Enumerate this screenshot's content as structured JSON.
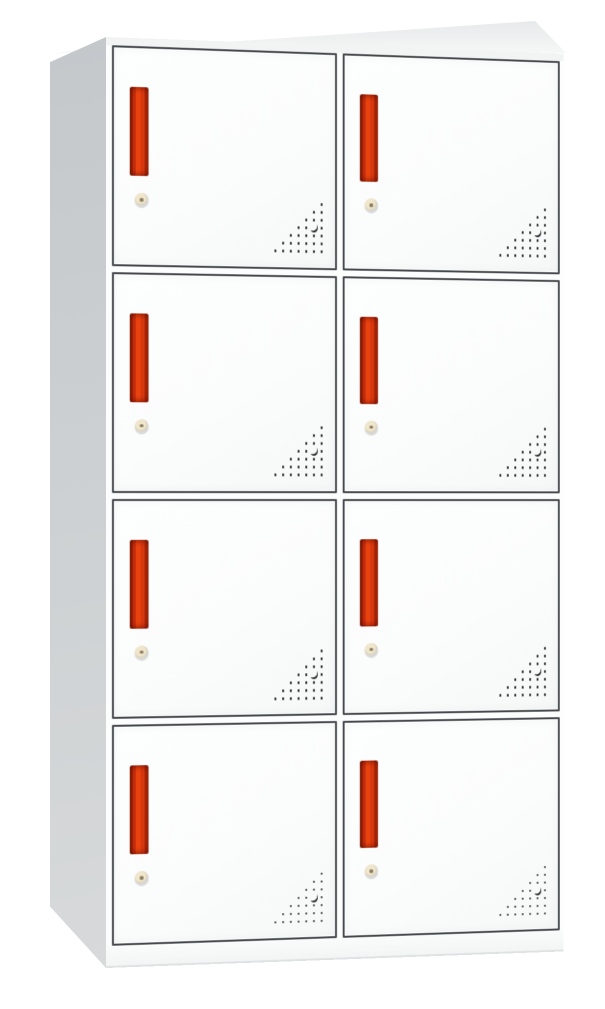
{
  "scene": {
    "object": "white steel locker cabinet with eight doors",
    "view": "three-quarter product photo, left side and top visible",
    "background": "#ffffff"
  },
  "cabinet": {
    "rows": 4,
    "columns": 2,
    "door_count": 8,
    "door_parts": {
      "handle": "red recessed vertical pull handle",
      "lock": "round cam key lock",
      "vent": "triangular perforation pattern, lower-right corner"
    }
  },
  "vent": {
    "size": 7,
    "shape": "right-triangle of holes, right-aligned, largest row at bottom",
    "crescent": {
      "row": 3,
      "col": 5
    }
  },
  "colors": {
    "background": "#ffffff",
    "body-white": "#fcfdfd",
    "door-face": "#fbfcfc",
    "frame-line": "#45494c",
    "side-top": "#c4c8cb",
    "side-bottom": "#d7d9da",
    "top-back": "#e7e9ea",
    "top-front": "#f6f7f7",
    "plinth": "#fafbfb",
    "handle-red": "#d6370f",
    "handle-red-bright": "#e8430f",
    "handle-red-dark": "#8e1f07",
    "handle-red-shadow": "#a42508",
    "lock-ring": "#d5d7d7",
    "lock-face": "#f0e6cc",
    "lock-pin": "#8b7f63",
    "vent-dot": "#26292b"
  }
}
